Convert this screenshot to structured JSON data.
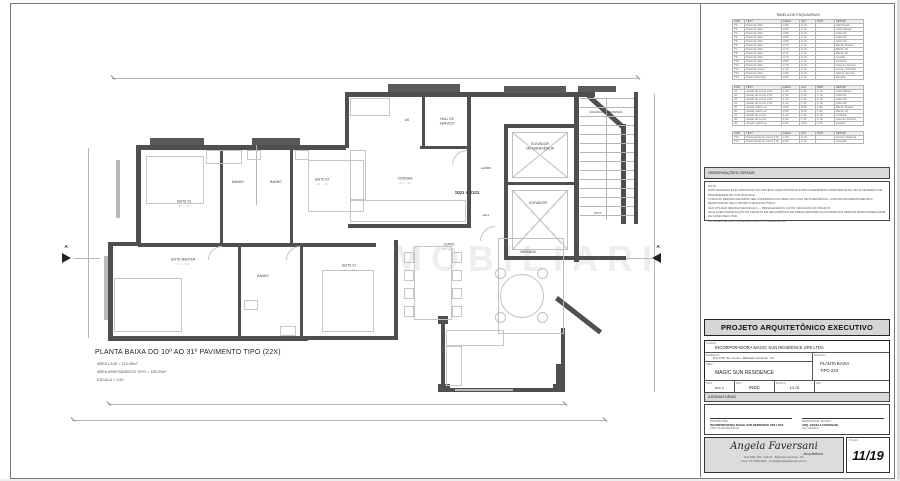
{
  "sheet": {
    "watermark": "MOBILIARI"
  },
  "plan": {
    "title": "PLANTA BAIXA DO 10º AO 31º PAVIMENTO TIPO (22X)",
    "area_laje": "ÁREA LAJE = 213,98m²",
    "area_apto": "ÁREA APARTAMENTO TIPO = 185,33m²",
    "escala": "ESCALA = 1:50",
    "unit_label": "1001 A 3101",
    "section_marker": "A",
    "rooms": {
      "suite03": {
        "label": "SUITE 03",
        "area": "A = ··,··m²"
      },
      "banho_s3": {
        "label": "BANHO",
        "area": ""
      },
      "banho_s2": {
        "label": "BANHO",
        "area": ""
      },
      "suite02": {
        "label": "SUITE 02",
        "area": "A = ··,··m²"
      },
      "cozinha": {
        "label": "COZINHA",
        "area": "A = ··,··m²"
      },
      "as": {
        "label": "AS",
        "area": ""
      },
      "hall_servico": {
        "label": "HALL DE\nSERVIÇO",
        "area": ""
      },
      "elev_em": {
        "label": "ELEVADOR\nDE EMERGÊNCIA",
        "area": ""
      },
      "elevador": {
        "label": "ELEVADOR",
        "area": ""
      },
      "lavabo": {
        "label": "LAVABO",
        "area": ""
      },
      "hall": {
        "label": "HALL",
        "area": ""
      },
      "duto": {
        "label": "DUTO",
        "area": ""
      },
      "escada": {
        "label": "ESCADA PRESSURIZADA",
        "area": ""
      },
      "suite_master": {
        "label": "SUITE MASTER",
        "area": "A = ··,··m²"
      },
      "banho_master": {
        "label": "BANHO",
        "area": ""
      },
      "suite01": {
        "label": "SUITE 01",
        "area": "A = ··,··m²"
      },
      "living": {
        "label": "LIVING",
        "area": "A = ··,··m²"
      },
      "varanda": {
        "label": "VARANDA",
        "area": ""
      }
    }
  },
  "titleblock": {
    "esquadrias": {
      "title": "TABELA DE ESQUADRIAS",
      "columns": [
        "COD",
        "TIPO",
        "LARG.",
        "ALT.",
        "PEIT.",
        "SETOR"
      ],
      "groups": [
        [
          [
            "P1",
            "Porta de abrir",
            "0,90",
            "2,10",
            "-",
            "Hall Social"
          ],
          [
            "P2",
            "Porta de abrir",
            "0,80",
            "2,10",
            "-",
            "Suíte Master"
          ],
          [
            "P3",
            "Porta de abrir",
            "0,80",
            "2,10",
            "-",
            "Suíte 01"
          ],
          [
            "P4",
            "Porta de abrir",
            "0,80",
            "2,10",
            "-",
            "Suíte 02"
          ],
          [
            "P5",
            "Porta de abrir",
            "0,80",
            "2,10",
            "-",
            "Suíte 03"
          ],
          [
            "P6",
            "Porta de abrir",
            "0,70",
            "2,10",
            "-",
            "Banho Master"
          ],
          [
            "P7",
            "Porta de abrir",
            "0,70",
            "2,10",
            "-",
            "Banho 01"
          ],
          [
            "P8",
            "Porta de abrir",
            "0,70",
            "2,10",
            "-",
            "Banho 02"
          ],
          [
            "P9",
            "Porta de abrir",
            "0,70",
            "2,10",
            "-",
            "Lavabo"
          ],
          [
            "P10",
            "Porta de abrir",
            "0,80",
            "2,10",
            "-",
            "Cozinha"
          ],
          [
            "P11",
            "Porta de abrir",
            "0,70",
            "2,10",
            "-",
            "Área de Serviço"
          ],
          [
            "P12",
            "Porta de correr",
            "1,20",
            "2,10",
            "-",
            "Living / Cozinha"
          ],
          [
            "P13",
            "Porta de abrir",
            "0,90",
            "2,10",
            "-",
            "Hall de Serviço"
          ],
          [
            "P14",
            "Porta corta-fogo",
            "0,90",
            "2,10",
            "-",
            "Escada"
          ]
        ],
        [
          [
            "J1",
            "Janela de correr 2 fls",
            "1,50",
            "1,20",
            "1,10",
            "Suíte Master"
          ],
          [
            "J2",
            "Janela de correr 2 fls",
            "1,50",
            "1,20",
            "1,10",
            "Suíte 01"
          ],
          [
            "J3",
            "Janela de correr 2 fls",
            "1,20",
            "1,20",
            "1,10",
            "Suíte 02"
          ],
          [
            "J4",
            "Janela de correr 2 fls",
            "1,20",
            "1,20",
            "1,10",
            "Suíte 03"
          ],
          [
            "J5",
            "Janela máxim-ar",
            "0,60",
            "0,60",
            "1,60",
            "Banho Master"
          ],
          [
            "J6",
            "Janela máxim-ar",
            "0,60",
            "0,60",
            "1,60",
            "Banho 01"
          ],
          [
            "J7",
            "Janela de correr",
            "1,20",
            "1,20",
            "1,10",
            "Cozinha"
          ],
          [
            "J8",
            "Janela de correr",
            "1,00",
            "1,20",
            "1,10",
            "Área de Serviço"
          ],
          [
            "J9",
            "Janela máxim-ar",
            "0,60",
            "0,60",
            "1,60",
            "Lavabo"
          ]
        ],
        [
          [
            "PJ1",
            "Porta janela de correr 3 fls",
            "2,40",
            "2,10",
            "-",
            "Living / Varanda"
          ],
          [
            "PJ2",
            "Porta janela de correr 2 fls",
            "1,80",
            "2,10",
            "-",
            "Varanda"
          ]
        ]
      ]
    },
    "observacoes": {
      "title": "OBSERVAÇÕES GERAIS",
      "lines": [
        "NOTA:",
        "ESTE DESENHO É DE APROVAÇÃO DO PROJETO ARQUITETÔNICO E RECONHECIMENTO PERTINENTE DE USO E DE DIREITO DE PROPRIEDADE DO CONTRATANTE.",
        "TODAS AS MEDIDAS DEVERÃO SER CONFERIDAS NA OBRA; EM CASO DE DIVERGÊNCIA, COMUNICAR IMEDIATAMENTE A RESPONSÁVEL PELO PROJETO ARQUITETÔNICO.",
        "NÃO UTILIZAR MEDIDAS EM ESCALA — PREVALECEM AS COTAS INDICADAS NO PROJETO.",
        "QUALQUER MODIFICAÇÃO NO PROJETO EM DECORRÊNCIA DE OBRAS SEM PRÉVIA AUTORIZAÇÃO SERÁ DE RESPONSABILIDADE DE QUEM EXECUTAR.",
        "COTAS EM METROS - NÍVEIS EM METROS - ÁREAS EM M²."
      ]
    },
    "project_header": "PROJETO ARQUITETÔNICO EXECUTIVO",
    "client": {
      "label": "CLIENTE",
      "value": "INCORPORADORA MAGIC SUN RESIDENCE SPE LTDA"
    },
    "endereco": {
      "label": "ENDEREÇO",
      "value": "Rua 3700, 99 - Centro - Balneário Camboriú - SC"
    },
    "obra": {
      "label": "OBRA",
      "value": "MAGIC SUN RESIDENCE"
    },
    "prancha": {
      "label": "PRANCHA",
      "line1": "PLANTA BAIXA",
      "line2": "TIPO 22X"
    },
    "meta": [
      {
        "label": "DATA",
        "value": "ESC.A"
      },
      {
        "label": "DES.",
        "value": "INDC"
      },
      {
        "label": "ESCALA",
        "value": "1/1.00"
      },
      {
        "label": "REV.",
        "value": ""
      }
    ],
    "assinaturas_label": "ASSINATURAS",
    "signatures": [
      {
        "label": "PROPRIETÁRIO",
        "name": "INCORPORADORA MAGIC SUN RESIDENCE SPE LTDA",
        "sub": "CNPJ: 00.000.000/0001-00"
      },
      {
        "label": "RESPONSÁVEL TÉCNICO",
        "name": "ARQ. ANGELA FAVERSANI",
        "sub": "CAU: A00000-0"
      }
    ],
    "logo": {
      "name": "Angela Faversani",
      "tag": "Arquitetura",
      "line1": "Rua 1500, 500 - Sala 01 - Balneário Camboriú - SC",
      "line2": "Fone: (47) 3360-0000 - contato@angelafaversani.com.br"
    },
    "folha": {
      "label": "FOLHA",
      "value": "11/19"
    }
  }
}
